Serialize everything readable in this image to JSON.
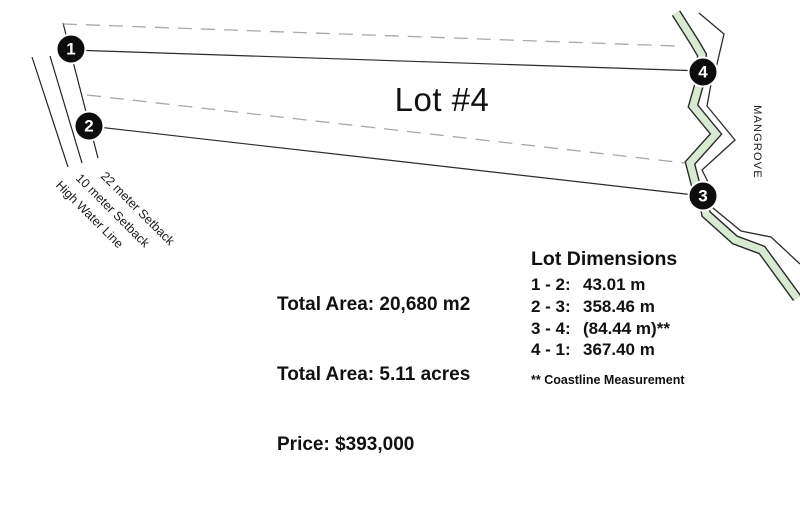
{
  "title": "Lot #4",
  "colors": {
    "mangrove_green": "#d9ead3",
    "line_dark": "#2b2b2b",
    "dashed_gray": "#a8a8a8",
    "marker_bg": "#0d0d0d",
    "marker_text": "#ffffff"
  },
  "markers": [
    {
      "label": "1"
    },
    {
      "label": "2"
    },
    {
      "label": "3"
    },
    {
      "label": "4"
    }
  ],
  "map_labels": {
    "setback_22": "22 meter Setback",
    "setback_10": "10 meter Setback",
    "high_water": "High Water Line",
    "mangrove": "MANGROVE"
  },
  "summary": {
    "lines": [
      "Total Area: 20,680 m2",
      "Total Area: 5.11 acres",
      "Price: $393,000"
    ]
  },
  "dimensions": {
    "heading": "Lot Dimensions",
    "rows": [
      {
        "label": "1 - 2:",
        "value": "43.01 m"
      },
      {
        "label": "2 - 3:",
        "value": "358.46 m"
      },
      {
        "label": "3 - 4:",
        "value": "(84.44 m)**"
      },
      {
        "label": "4 - 1:",
        "value": "367.40 m"
      }
    ],
    "footnote": "** Coastline Measurement"
  }
}
